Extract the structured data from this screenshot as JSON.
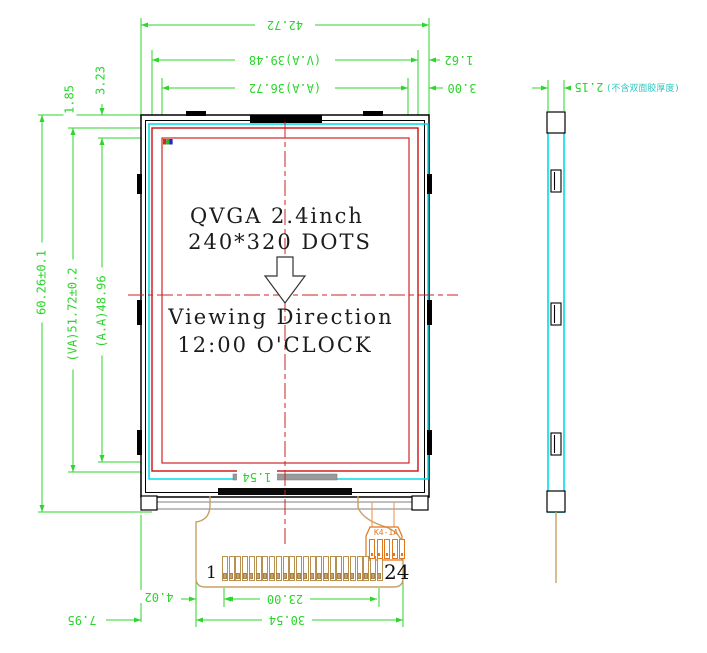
{
  "drawing": {
    "display_label": {
      "line1": "QVGA 2.4inch",
      "line2": "240*320 DOTS",
      "viewing_line1": "Viewing Direction",
      "viewing_line2": "12:00 O'CLOCK"
    },
    "dims": {
      "overall_width": "42.72",
      "va_width": "(V.A)39.48",
      "aa_width": "(A.A)36.72",
      "edge_to_va_right": "1.62",
      "edge_to_aa_right": "3.00",
      "overall_height": "60.26±0.1",
      "va_height": "(VA)51.72±0.2",
      "aa_height": "(A.A)48.96",
      "edge_to_va_top": "1.85",
      "edge_to_aa_top": "3.23",
      "bar_offset": "1.54",
      "fpc_pad_margin": "4.02",
      "edge_to_fpc": "7.95",
      "pin_span": "23.00",
      "fpc_width": "30.54",
      "thickness": "2.15",
      "thickness_note": "(不含双面胶厚度)"
    },
    "connector": {
      "pin_first": "1",
      "pin_last": "24",
      "pin_count": 24,
      "label": "K4-1A"
    },
    "colors": {
      "dimension_green": "#2dd52d",
      "outline_black": "#000000",
      "area_red": "#cc1111",
      "polarizer_cyan": "#00dce8",
      "centerline_red": "#cc2222",
      "fpc_tan": "#c9a063",
      "component_orange": "#e2761b"
    }
  }
}
